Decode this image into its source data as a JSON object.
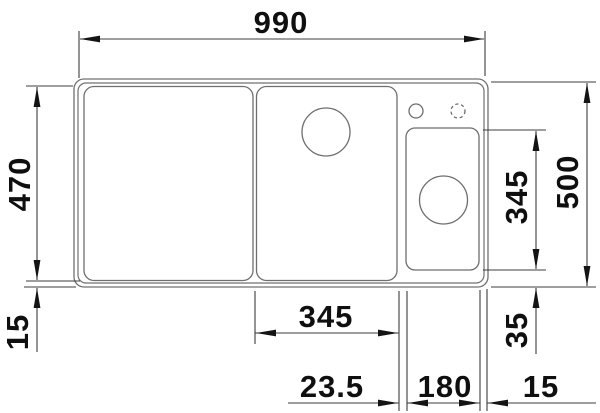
{
  "figure": {
    "type": "technical-dimension-drawing",
    "subject": "kitchen sink top view with two bowls, drainboard, tap holes and dimension lines",
    "background_color": "#ffffff",
    "outline_color": "#707070",
    "dimension_line_color": "#3c3c3c",
    "text_color": "#0f0f0f"
  },
  "dimensions": {
    "total_width": "990",
    "inner_depth": "470",
    "front_rim": "15",
    "total_depth": "500",
    "main_bowl_width": "345",
    "right_bowl_depth": "345",
    "right_bowl_bottom_offset": "35",
    "bowl_gap": "23.5",
    "right_bowl_width": "180",
    "right_rim": "15"
  }
}
